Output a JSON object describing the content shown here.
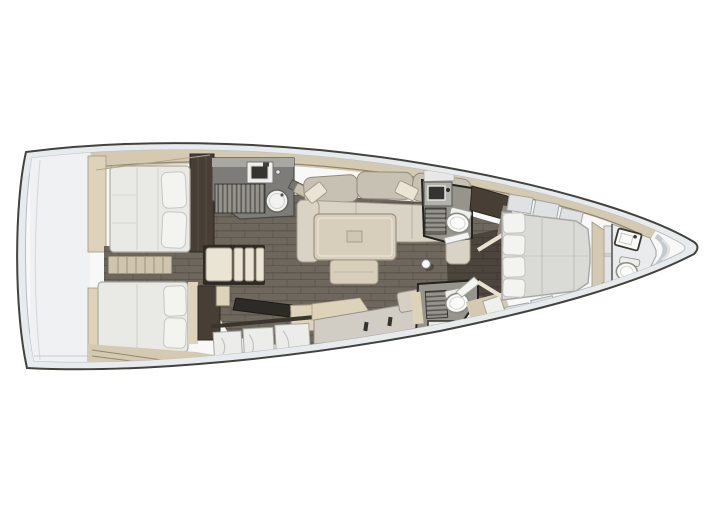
{
  "meta": {
    "title": "Sailing yacht interior layout plan, top-down, bow pointing right",
    "type": "floor-plan"
  },
  "colors": {
    "hull_outline": "#43433e",
    "deck_rim": "#e8ebed",
    "hull_white": "#f7f8f7",
    "transom": "#f0f1f3",
    "deck_beige": "#d4cab2",
    "band_edge": "#8f8674",
    "wall_beige": "#ddd3ba",
    "wood_dark": "#473f35",
    "floor_brown": "#6e675e",
    "floor_dark": "#4b453e",
    "counter_gray": "#7e7c78",
    "counter_light": "#a9a7a2",
    "grate_gray": "#95938c",
    "mattress": "#e9e9e6",
    "mattress_fwd": "#dadad7",
    "pillow": "#f3f3f0",
    "sofa_back": "#c7c1b3",
    "sofa_seat": "#d9d3c6",
    "cushion": "#e9e4d4",
    "table": "#d7cfbc",
    "marble": "#ececea",
    "head_bg": "#97948d",
    "fixture_white": "#fbfbfa",
    "fixture_dark": "#353431",
    "door_white": "#f4f4f2"
  },
  "rooms": [
    {
      "name": "aft-cabin-port",
      "fixtures": [
        "double-berth",
        "pillows",
        "wardrobe"
      ]
    },
    {
      "name": "aft-cabin-starboard",
      "fixtures": [
        "double-berth",
        "pillows",
        "wardrobe"
      ]
    },
    {
      "name": "companionway",
      "fixtures": [
        "steps-seat",
        "engine-step"
      ]
    },
    {
      "name": "galley",
      "fixtures": [
        "sink",
        "stove-grate",
        "round-sink",
        "cutting-board"
      ]
    },
    {
      "name": "saloon",
      "fixtures": [
        "l-sofa",
        "throw-pillows",
        "dining-table",
        "ottoman",
        "stool"
      ]
    },
    {
      "name": "nav-area",
      "fixtures": [
        "chart-desk",
        "cabinet",
        "marble-counter"
      ]
    },
    {
      "name": "head-port",
      "fixtures": [
        "vanity",
        "shower-grate",
        "toilet",
        "door"
      ]
    },
    {
      "name": "head-starboard",
      "fixtures": [
        "shower-grate",
        "toilet",
        "sink",
        "door"
      ]
    },
    {
      "name": "forward-cabin",
      "fixtures": [
        "island-berth",
        "pillows",
        "foot-bench",
        "lockers"
      ]
    },
    {
      "name": "bow-head",
      "fixtures": [
        "sink",
        "toilet"
      ]
    },
    {
      "name": "mast",
      "fixtures": [
        "mast-post"
      ]
    }
  ]
}
